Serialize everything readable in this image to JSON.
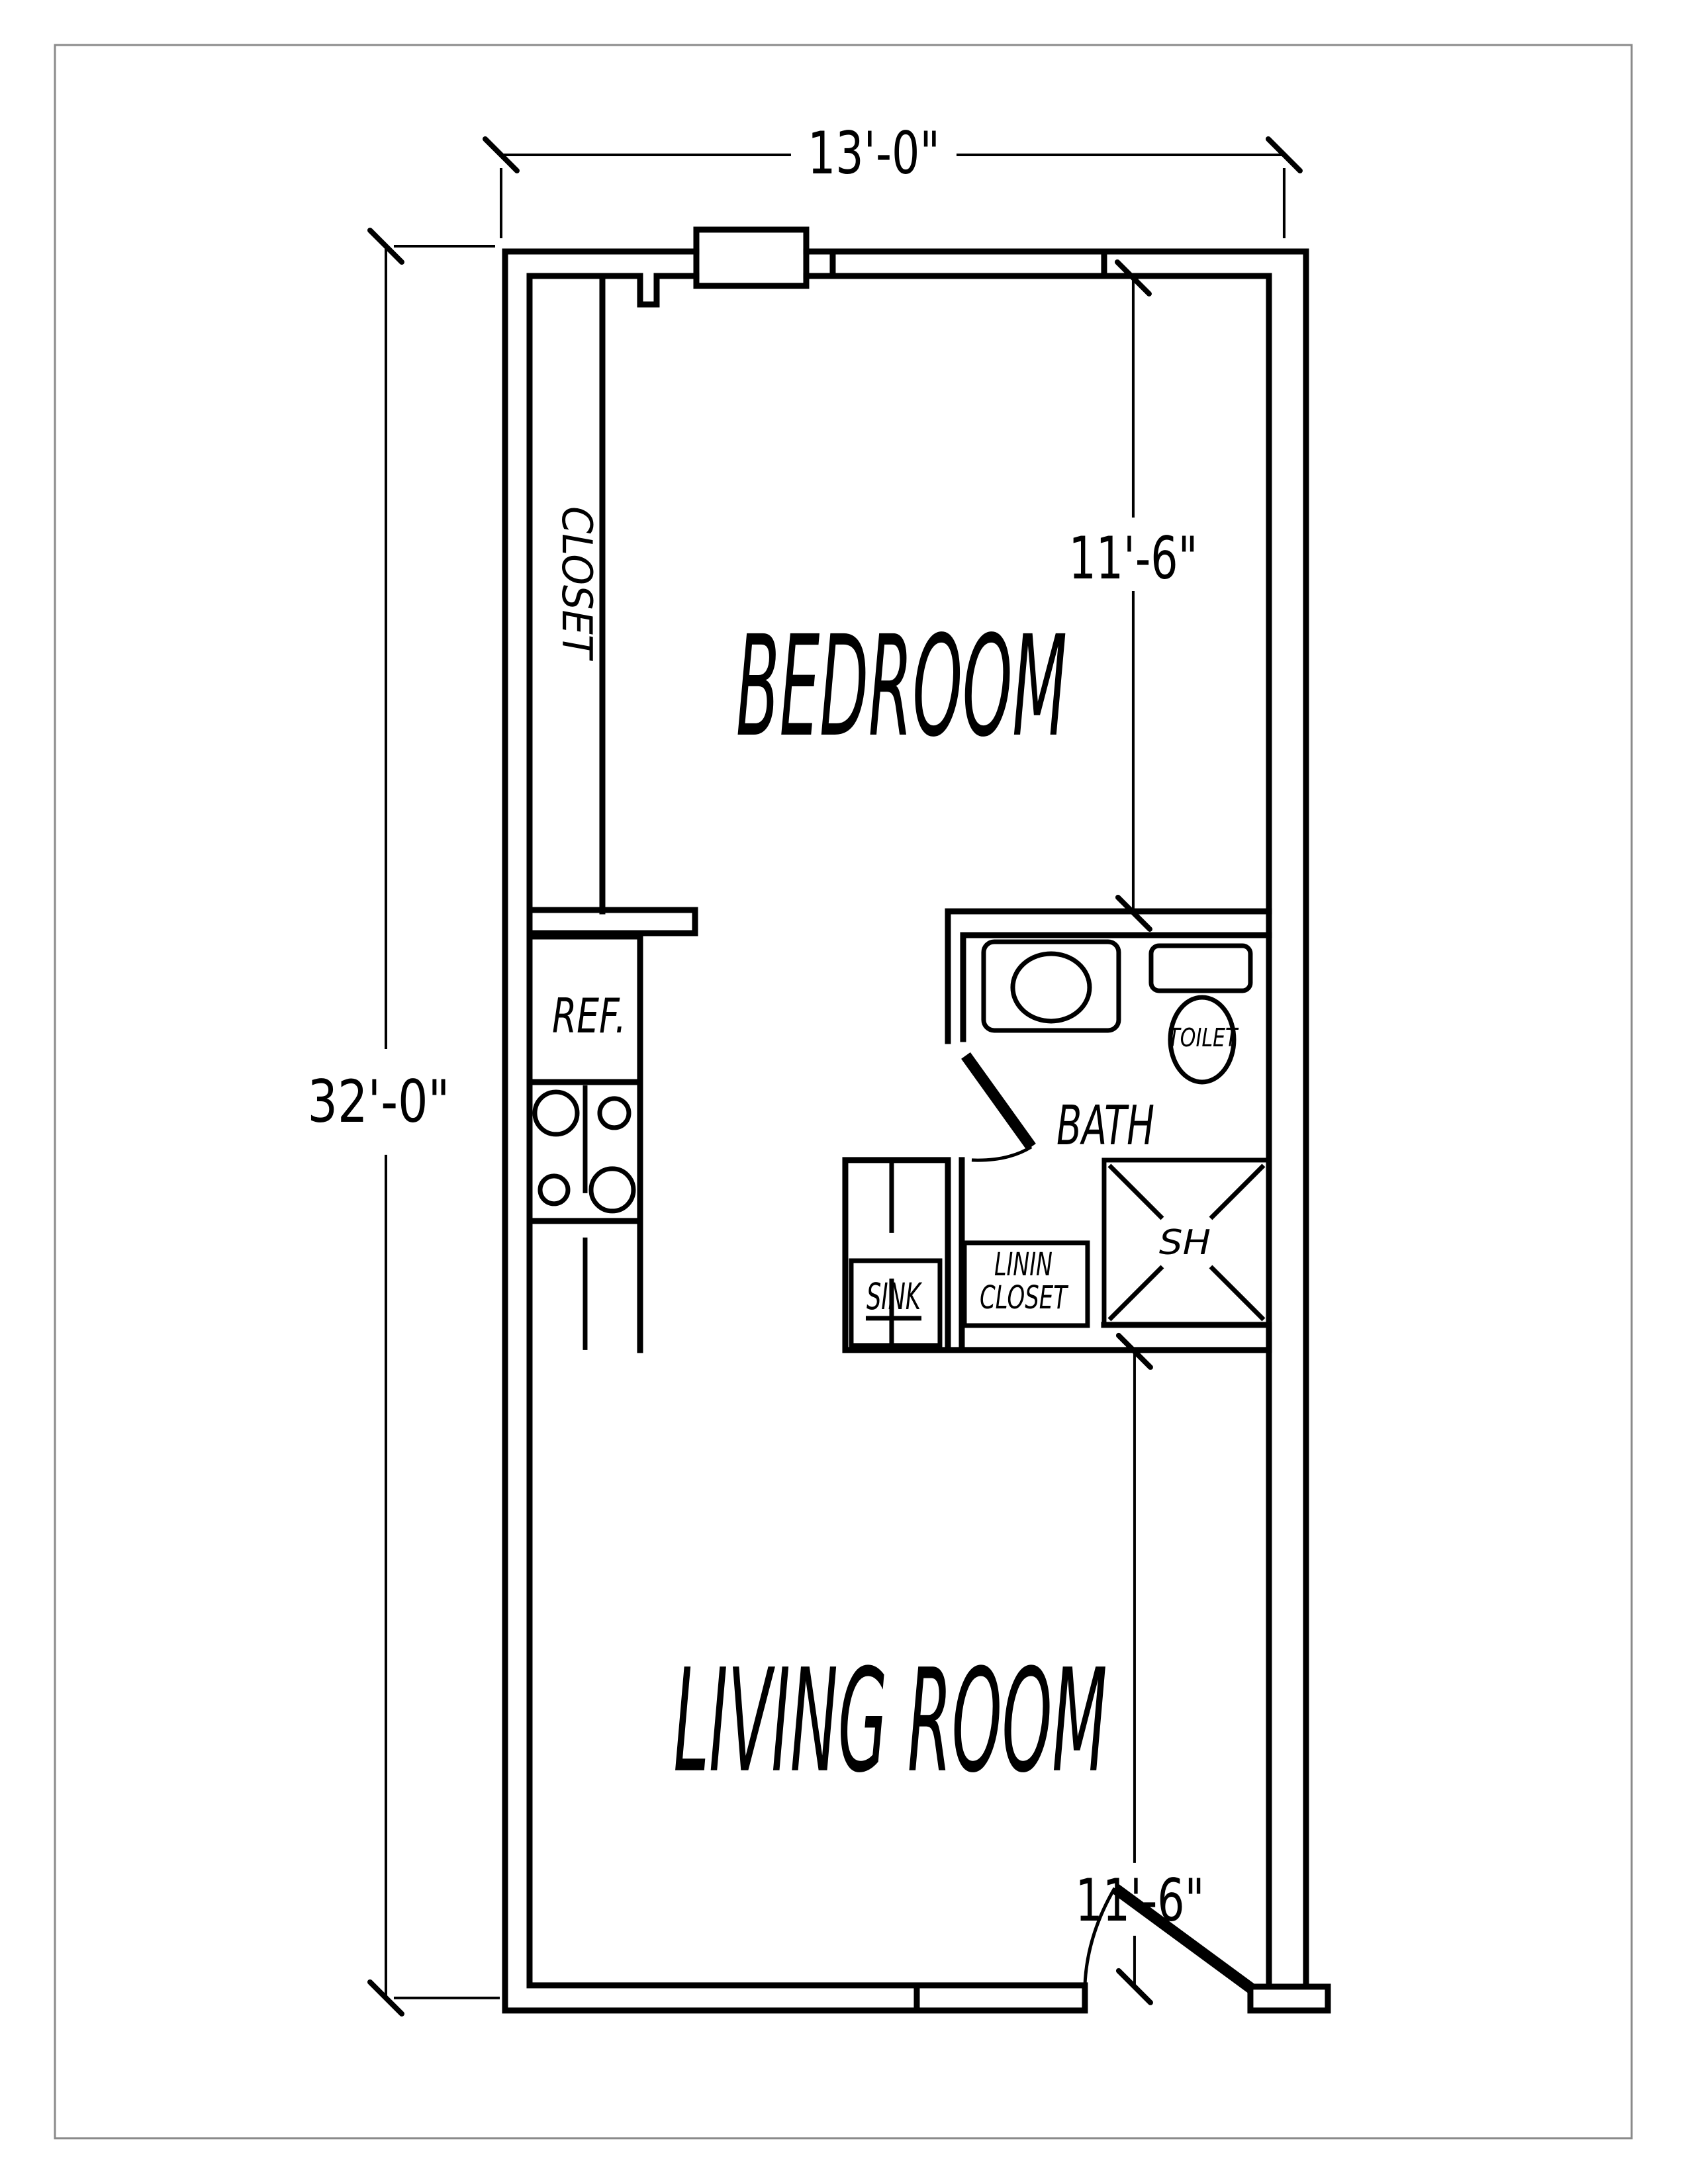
{
  "title": "One-bedroom apartment floor plan",
  "colors": {
    "ink": "#000000",
    "paper": "#ffffff",
    "frame": "#8a8a8a"
  },
  "dimensions": {
    "overall_width": "13'-0\"",
    "overall_height": "32'-0\"",
    "bedroom_width": "11'-6\"",
    "living_room_width": "11'-6\""
  },
  "rooms": {
    "bedroom": "BEDROOM",
    "living_room": "LIVING ROOM",
    "bath": "BATH",
    "closet": "CLOSET"
  },
  "fixtures": {
    "refrigerator": "REF.",
    "sink": "SINK",
    "linen_closet_line1": "LININ",
    "linen_closet_line2": "CLOSET",
    "toilet": "TOILET",
    "shower": "SH"
  }
}
